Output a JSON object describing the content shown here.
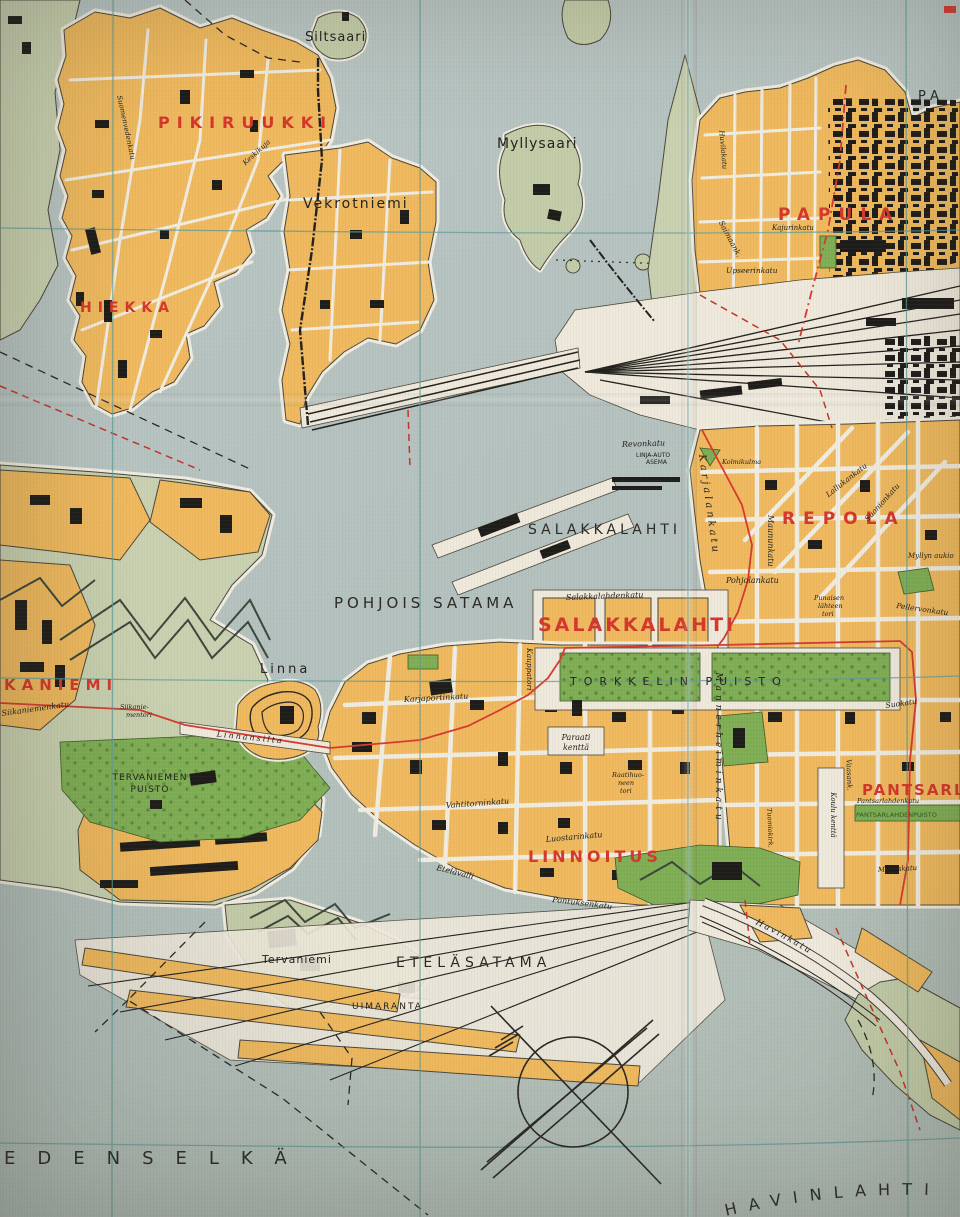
{
  "colors": {
    "water": "#b6c2bf",
    "land_pale_green": "#c9d1b0",
    "island_green": "#c3cca8",
    "city_block_orange": "#f0b95d",
    "park_green": "#7fae54",
    "building_black": "#1f1d1a",
    "street_white": "#efe9dc",
    "graticule_teal": "#5f9b95",
    "route_red": "#d63a30",
    "district_label_red": "#d6372b"
  },
  "symbols": {
    "compass_rose": "crossed-bearing-lines-in-circle"
  },
  "labels": {
    "pikiruukki": "PIKIRUUKKI",
    "hiekka": "HIEKKA",
    "papula": "PAPULA",
    "repola": "REPOLA",
    "salakkalahti_district": "SALAKKALAHTI",
    "linnoitus": "LINNOITUS",
    "pantsarlahti": "PANTSARLAHTI",
    "kaniemi": "KANIEMI",
    "siltsaari": "Siltsaari",
    "myllysaari": "Myllysaari",
    "vekrotniemi": "Vekrotniemi",
    "salakkalahti_bay": "SALAKKALAHTI",
    "pohjois_satama": "POHJOIS SATAMA",
    "etelasatama": "ETELÄSATAMA",
    "edenselka": "EDENSELKÄ",
    "havinlahti": "HAVINLAHTI",
    "pa_partial": "PA",
    "linna": "Linna",
    "tervaniemi": "Tervaniemi",
    "uimaranta": "UIMARANTA",
    "tervaniemen_puisto_1": "TERVANIEMEN",
    "tervaniemen_puisto_2": "PUISTO",
    "torkkelin_puisto": "TORKKELIN PUISTO",
    "revonkatu": "Revonkatu",
    "linja_auto_1": "LINJA-AUTO",
    "linja_auto_2": "ASEMA",
    "salakkalahdenkatu": "Salakkalahdenkatu",
    "kauppatori": "Kauppatori",
    "pohjolankatu": "Pohjolankatu",
    "maununkatu": "Maununkatu",
    "punaisenlahteentori_1": "Punaisen",
    "punaisenlahteentori_2": "lähteen",
    "punaisenlahteentori_3": "tori",
    "lallukankatu": "Lallukankatu",
    "suonionkatu": "Suonionkatu",
    "kolmikulma": "Kolmikulma",
    "myllyn_aukio": "Myllyn aukio",
    "pellervonkatu": "Pellervonkatu",
    "suokatu": "Suokatu",
    "karjalankatu": "Karjalankatu",
    "mannerheiminkatu": "Mannerheiminkatu",
    "karjaportinkatu": "Karjaportinkatu",
    "paraati_1": "Paraati",
    "paraati_2": "kenttä",
    "raatihuoneentori_1": "Raatihuo-",
    "raatihuoneentori_2": "neen",
    "raatihuoneentori_3": "tori",
    "vahtitorninkatu": "Vahtitorninkatu",
    "luostarinkatu": "Luostarinkatu",
    "pontuksenkatu": "Pontuksenkatu",
    "etelavalli": "Etelävalli",
    "havinkatu": "Havinkatu",
    "upseerinkatu": "Upseerinkatu",
    "saimaankatu": "Saimaank.",
    "huvilakatu": "Huvilakatu",
    "kajurinkatu": "Kajurinkatu",
    "siikaniemenkatu": "Siikaniemenkatu",
    "siikaniementori_1": "Siikanie-",
    "siikaniementori_2": "mentori",
    "linnansilta": "Linnansilta",
    "koulukentta": "Koulu kenttä",
    "pantsarlahdenkatu": "Pantsarlahdenkatu",
    "pantsarlahden_puisto": "PANTSARLAHDENPUISTO",
    "mallaskatu": "Mallaskatu",
    "vaasankatu": "Vaasank.",
    "keskikuja": "Keskikuja",
    "suomenvedenkatu": "Suomenvedenkatu",
    "tuomiokirkonkatu": "Tuomiokirk."
  }
}
